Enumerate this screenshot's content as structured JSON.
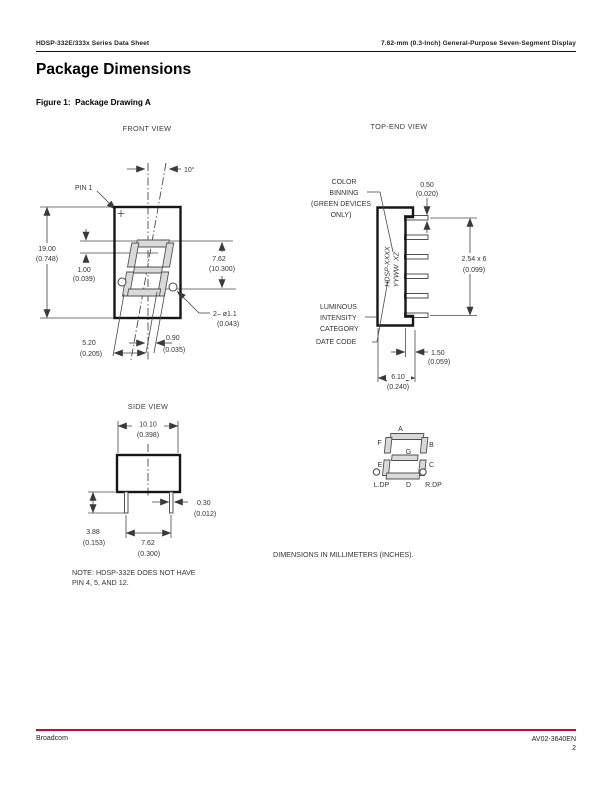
{
  "page": {
    "header_left": "HDSP-332E/333x Series Data Sheet",
    "header_right": "7.62-mm (0.3-Inch) General-Purpose Seven-Segment Display",
    "title": "Package Dimensions",
    "figure_caption": "Figure 1:  Package Drawing A",
    "note_line1": "NOTE: HDSP-332E DOES NOT HAVE",
    "note_line2": "PIN 4, 5, AND 12.",
    "dimensions_note": "DIMENSIONS IN MILLIMETERS (INCHES).",
    "footer_left": "Broadcom",
    "footer_doc": "AV02-3640EN",
    "footer_page": "2"
  },
  "colors": {
    "accent_rule": "#BE0D34",
    "drawing_line": "#3f3f3f",
    "segment_fill": "#d9d9d9"
  },
  "front_view": {
    "label": "FRONT VIEW",
    "pin1_label": "PIN 1",
    "angle_label": "10°",
    "dim_height": [
      "19.00",
      "(0.748)"
    ],
    "dim_one": [
      "1.00",
      "(0.039)"
    ],
    "dim_char": [
      "7.62",
      "(10.300)"
    ],
    "dim_holes": [
      "2– ø1.1",
      "(0.043)"
    ],
    "dim_090": [
      "0.90",
      "(0.035)"
    ],
    "dim_520": [
      "5.20",
      "(0.205)"
    ]
  },
  "top_end_view": {
    "label": "TOP-END VIEW",
    "color_binning": [
      "COLOR",
      "BINNING",
      "(GREEN DEVICES",
      "ONLY)"
    ],
    "dim_050": [
      "0.50",
      "(0.020)"
    ],
    "dim_pitch": [
      "2.54 x 6",
      "(0.099)"
    ],
    "marking_line1": "HDSP-XXXX",
    "marking_line2": "YYWW  XZ",
    "luminous": [
      "LUMINOUS",
      "INTENSITY",
      "CATEGORY"
    ],
    "date_code": "DATE CODE",
    "dim_150": [
      "1.50",
      "(0.059)"
    ],
    "dim_610": [
      "6.10",
      "(0.240)"
    ]
  },
  "side_view": {
    "label": "SIDE VIEW",
    "dim_width": [
      "10.10",
      "(0.398)"
    ],
    "dim_pin_len": [
      "3.88",
      "(0.153)"
    ],
    "dim_pin_w": [
      "0.30",
      "(0.012)"
    ],
    "dim_pitch": [
      "7.62",
      "(0.300)"
    ]
  },
  "segment_diagram": {
    "seg_a": "A",
    "seg_b": "B",
    "seg_c": "C",
    "seg_d": "D",
    "seg_e": "E",
    "seg_f": "F",
    "seg_g": "G",
    "ldp": "L.DP",
    "d_label": "D",
    "rdp": "R.DP"
  }
}
